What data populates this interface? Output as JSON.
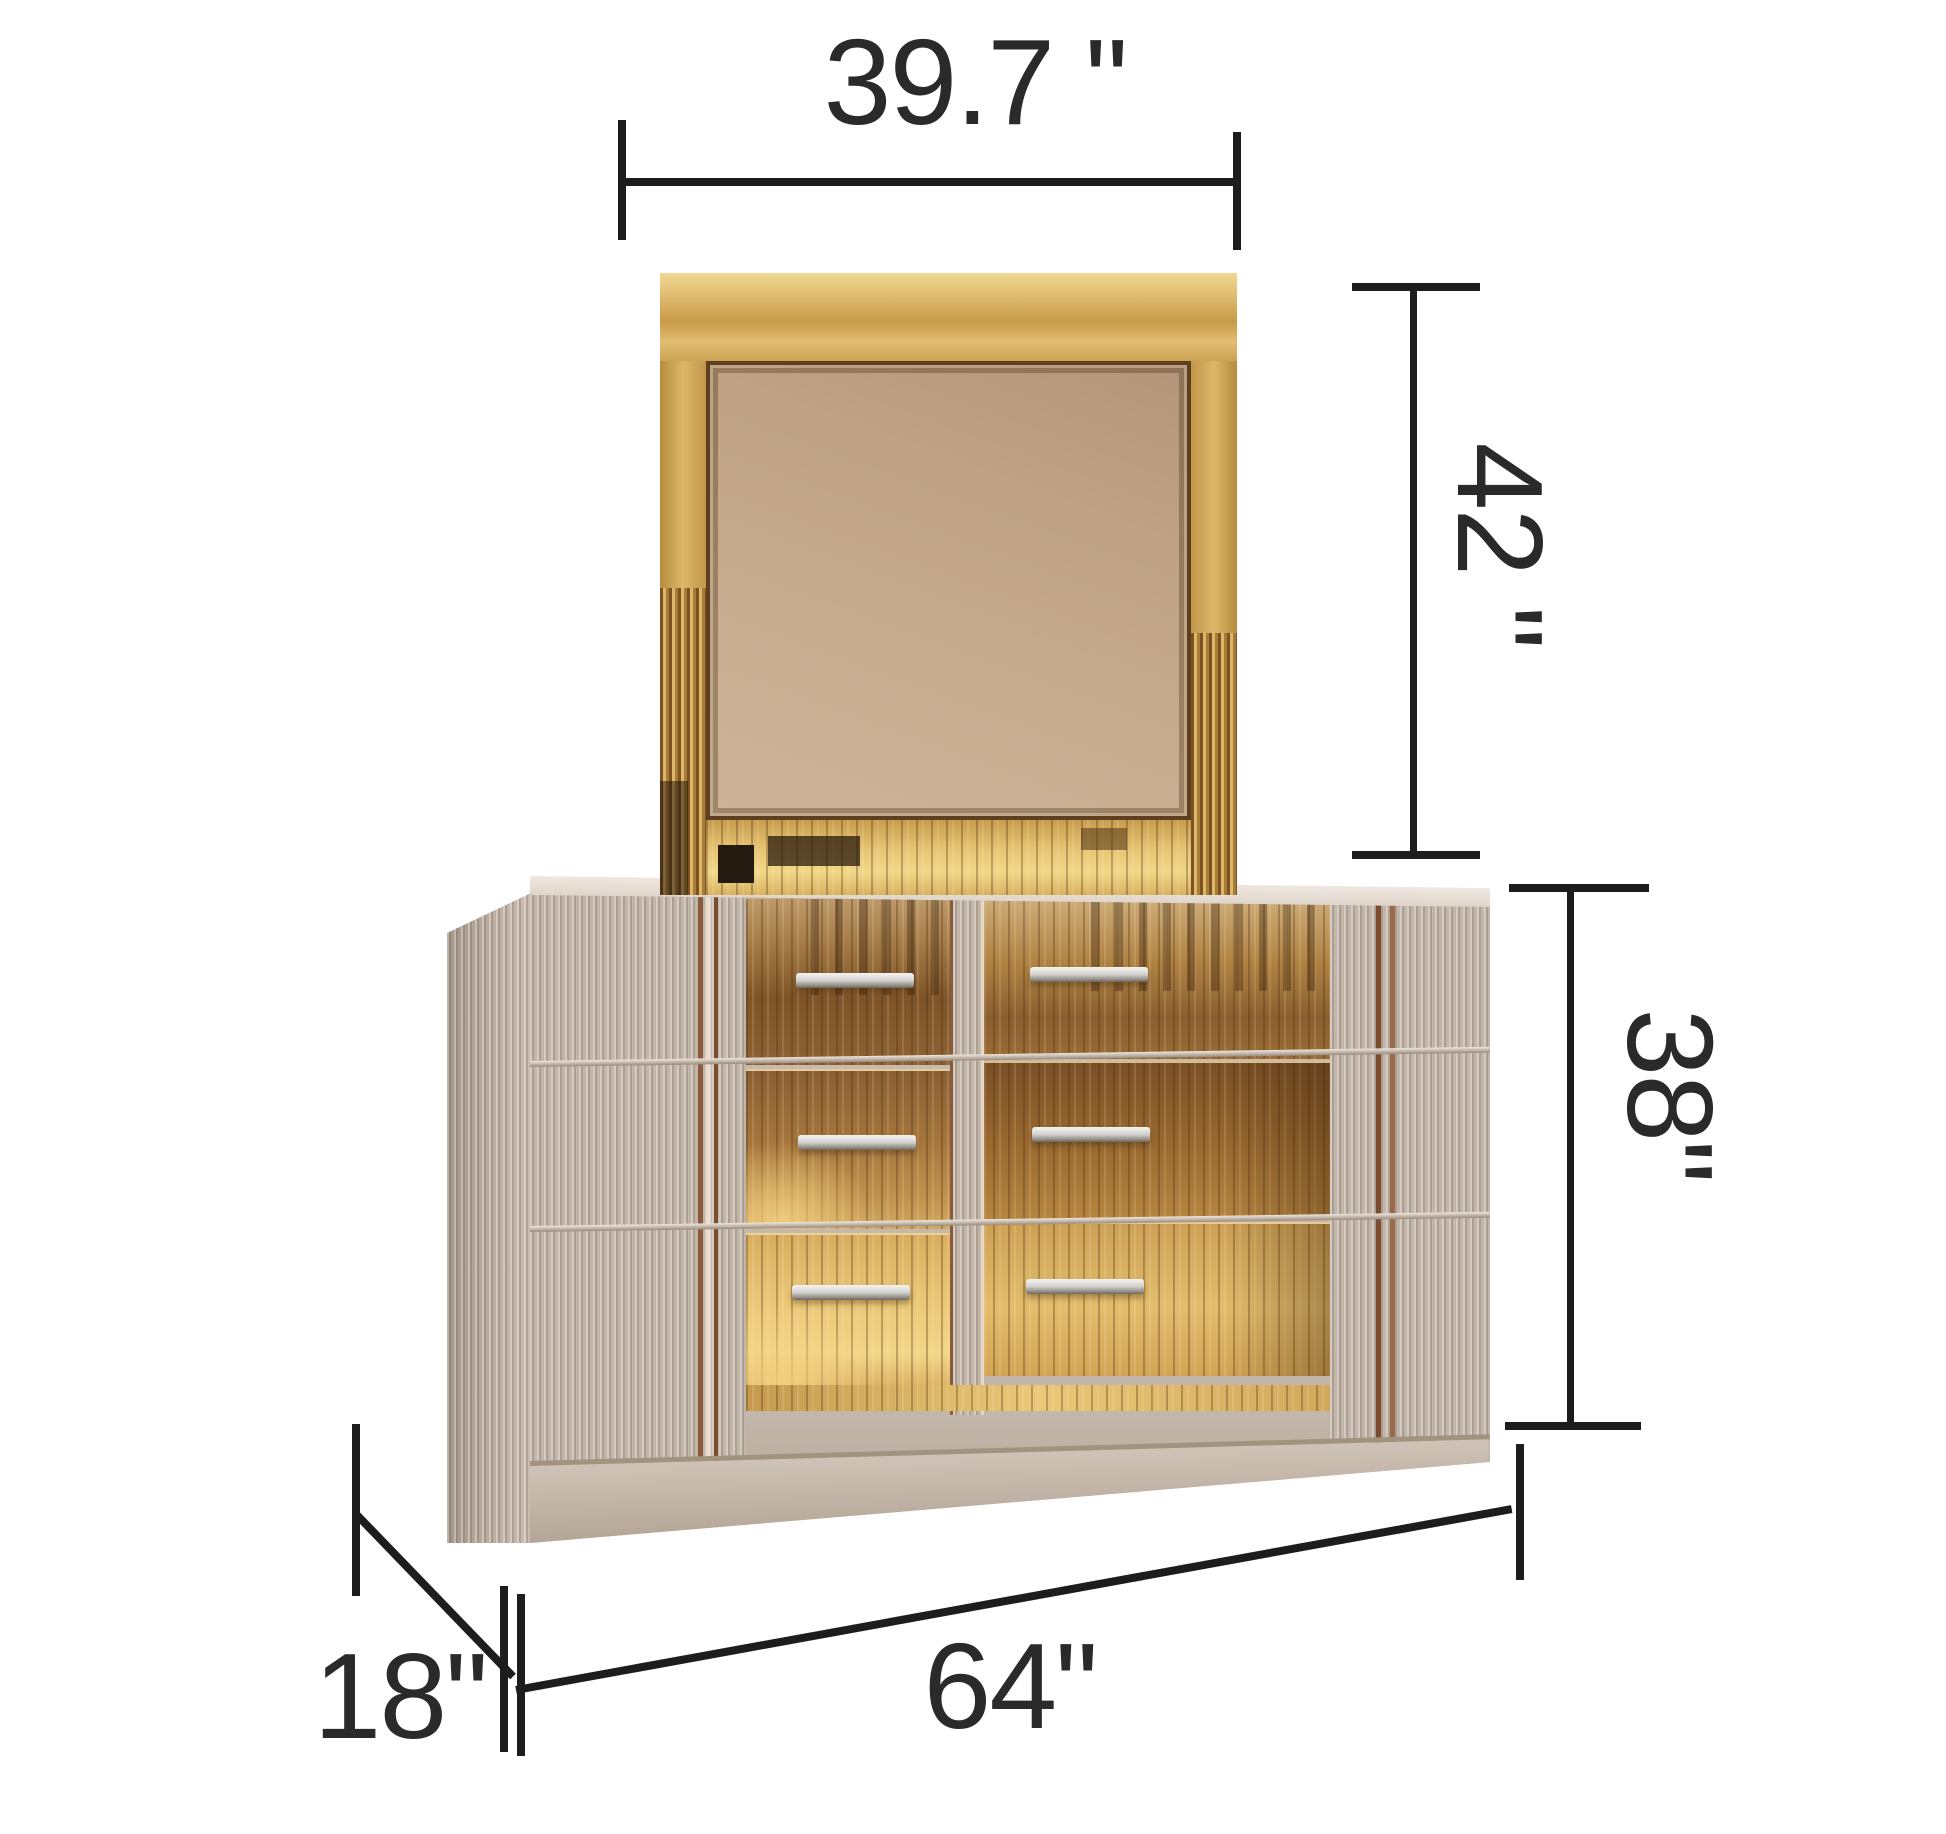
{
  "diagram": {
    "type": "furniture-dimension-diagram",
    "item": "mirrored dresser with mirror",
    "dimensions": {
      "mirror_width": "39.7 \"",
      "mirror_height": "42 \"",
      "dresser_height": "38\"",
      "dresser_width": "64\"",
      "dresser_depth": "18\""
    },
    "colors": {
      "background": "#ffffff",
      "dimension_lines": "#1d1d1d",
      "label_text": "#2a2a2a",
      "mirror_frame_gold": "#d8b266",
      "mirror_glass": "#c6a98c",
      "panel_greige": "#c3b6aa",
      "drawer_bronze": "#b08347",
      "handle_chrome": "#d9d8d5"
    }
  }
}
